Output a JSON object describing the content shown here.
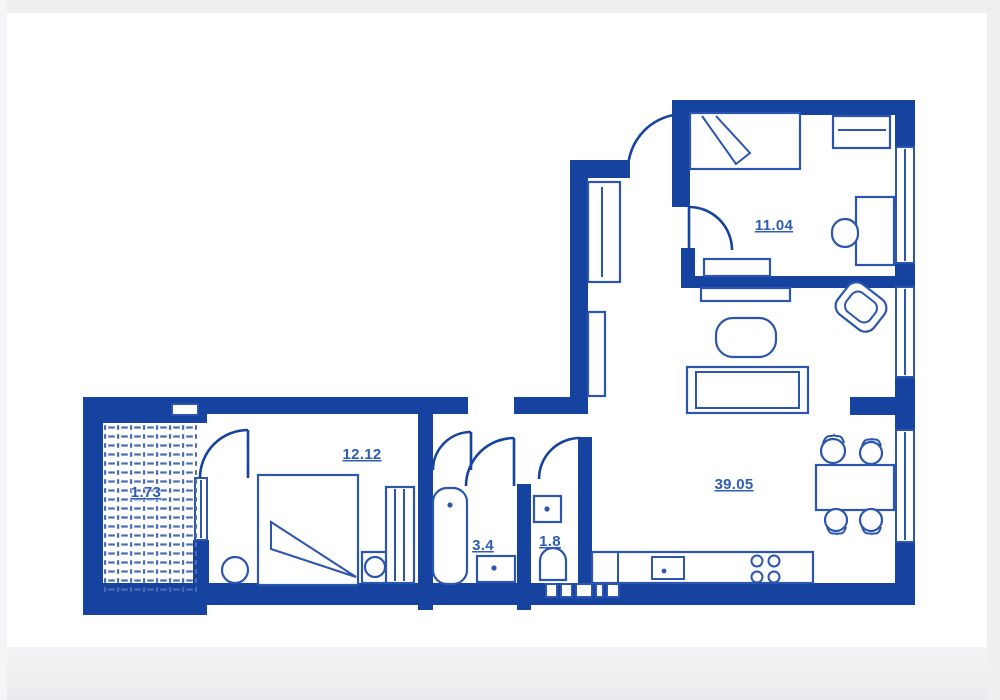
{
  "title": "Apartment floor plan",
  "colors": {
    "wall": "#16439f",
    "furniture_stroke": "#2b55ae",
    "label_text": "#2e5cb8",
    "background": "#ffffff",
    "page_margin": "#edeff1"
  },
  "rooms": {
    "balcony": {
      "name": "balcony",
      "area": "1.73"
    },
    "bedroom": {
      "name": "bedroom",
      "area": "12.12"
    },
    "bathroom": {
      "name": "bathroom",
      "area": "3.4"
    },
    "wc": {
      "name": "wc",
      "area": "1.8"
    },
    "child_room": {
      "name": "second bedroom",
      "area": "11.04"
    },
    "living_kitchen": {
      "name": "living room + kitchen",
      "area": "39.05"
    }
  }
}
